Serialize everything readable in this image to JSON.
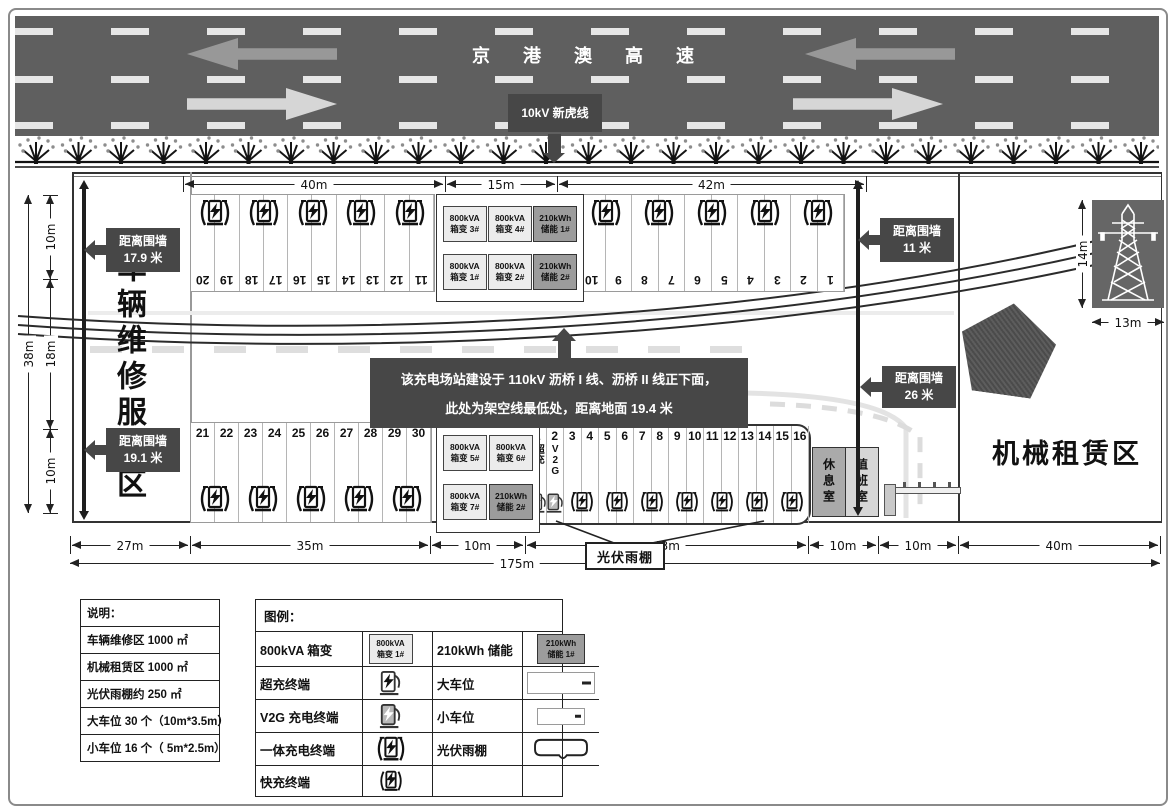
{
  "highway": {
    "title": "京 港 澳 高 速",
    "line_label": "10kV 新虎线"
  },
  "labels": {
    "maintenance_area": "车辆维修服务区",
    "machinery_area": "机械租赁区",
    "rest_room": "休息室",
    "duty_room": "值班室",
    "super_charge": "超充",
    "v2g": "V2G",
    "canopy": "光伏雨棚"
  },
  "wall_distance_labels": [
    {
      "line1": "距离围墙",
      "line2": "17.9 米"
    },
    {
      "line1": "距离围墙",
      "line2": "19.1 米"
    },
    {
      "line1": "距离围墙",
      "line2": "11 米"
    },
    {
      "line1": "距离围墙",
      "line2": "26 米"
    }
  ],
  "annotation": {
    "line1": "该充电场站建设于 110kV 沥桥 I 线、沥桥 II 线正下面，",
    "line2": "此处为架空线最低处，距离地面 19.4 米"
  },
  "dimensions": {
    "top": [
      "40m",
      "15m",
      "42m"
    ],
    "bottom": [
      "27m",
      "35m",
      "10m",
      "43m",
      "10m",
      "10m",
      "40m"
    ],
    "total": "175m",
    "left_outer": "38m",
    "left_inner": [
      "10m",
      "18m",
      "10m"
    ],
    "tower_height": "14m",
    "tower_width": "13m"
  },
  "parking": {
    "top_left": [
      "20",
      "19",
      "18",
      "17",
      "16",
      "15",
      "14",
      "13",
      "12",
      "11"
    ],
    "top_right": [
      "10",
      "9",
      "8",
      "7",
      "6",
      "5",
      "4",
      "3",
      "2",
      "1"
    ],
    "bottom_left": [
      "21",
      "22",
      "23",
      "24",
      "25",
      "26",
      "27",
      "28",
      "29",
      "30"
    ],
    "canopy": [
      "1",
      "2",
      "3",
      "4",
      "5",
      "6",
      "7",
      "8",
      "9",
      "10",
      "11",
      "12",
      "13",
      "14",
      "15",
      "16"
    ]
  },
  "equipment_top": [
    {
      "top": "800kVA",
      "bottom": "箱变 3#",
      "dark": false
    },
    {
      "top": "800kVA",
      "bottom": "箱变 4#",
      "dark": false
    },
    {
      "top": "210kWh",
      "bottom": "储能 1#",
      "dark": true
    },
    {
      "top": "800kVA",
      "bottom": "箱变 1#",
      "dark": false
    },
    {
      "top": "800kVA",
      "bottom": "箱变 2#",
      "dark": false
    },
    {
      "top": "210kWh",
      "bottom": "储能 2#",
      "dark": true
    }
  ],
  "equipment_bottom": [
    {
      "top": "800kVA",
      "bottom": "箱变 5#",
      "dark": false
    },
    {
      "top": "800kVA",
      "bottom": "箱变 6#",
      "dark": false
    },
    {
      "top": "800kVA",
      "bottom": "箱变 7#",
      "dark": false
    },
    {
      "top": "210kWh",
      "bottom": "储能 2#",
      "dark": true
    }
  ],
  "notes": {
    "title": "说明：",
    "rows": [
      "车辆维修区 1000 ㎡",
      "机械租赁区 1000 ㎡",
      "光伏雨棚约 250 ㎡",
      "大车位 30 个（10m*3.5m）",
      "小车位 16 个（ 5m*2.5m）"
    ]
  },
  "legend": {
    "title": "图例：",
    "left": [
      {
        "label": "800kVA 箱变",
        "icon": "transformer"
      },
      {
        "label": "超充终端",
        "icon": "supercharger"
      },
      {
        "label": "V2G 充电终端",
        "icon": "v2g"
      },
      {
        "label": "一体充电终端",
        "icon": "integrated"
      },
      {
        "label": "快充终端",
        "icon": "fast"
      }
    ],
    "right": [
      {
        "label": "210kWh 储能",
        "icon": "storage"
      },
      {
        "label": "大车位",
        "icon": "large-space"
      },
      {
        "label": "小车位",
        "icon": "small-space"
      },
      {
        "label": "光伏雨棚",
        "icon": "canopy-shape"
      },
      {
        "label": "",
        "icon": "none"
      }
    ],
    "transformer_sample": {
      "top": "800kVA",
      "bottom": "箱变 1#"
    },
    "storage_sample": {
      "top": "210kWh",
      "bottom": "储能 1#"
    }
  }
}
